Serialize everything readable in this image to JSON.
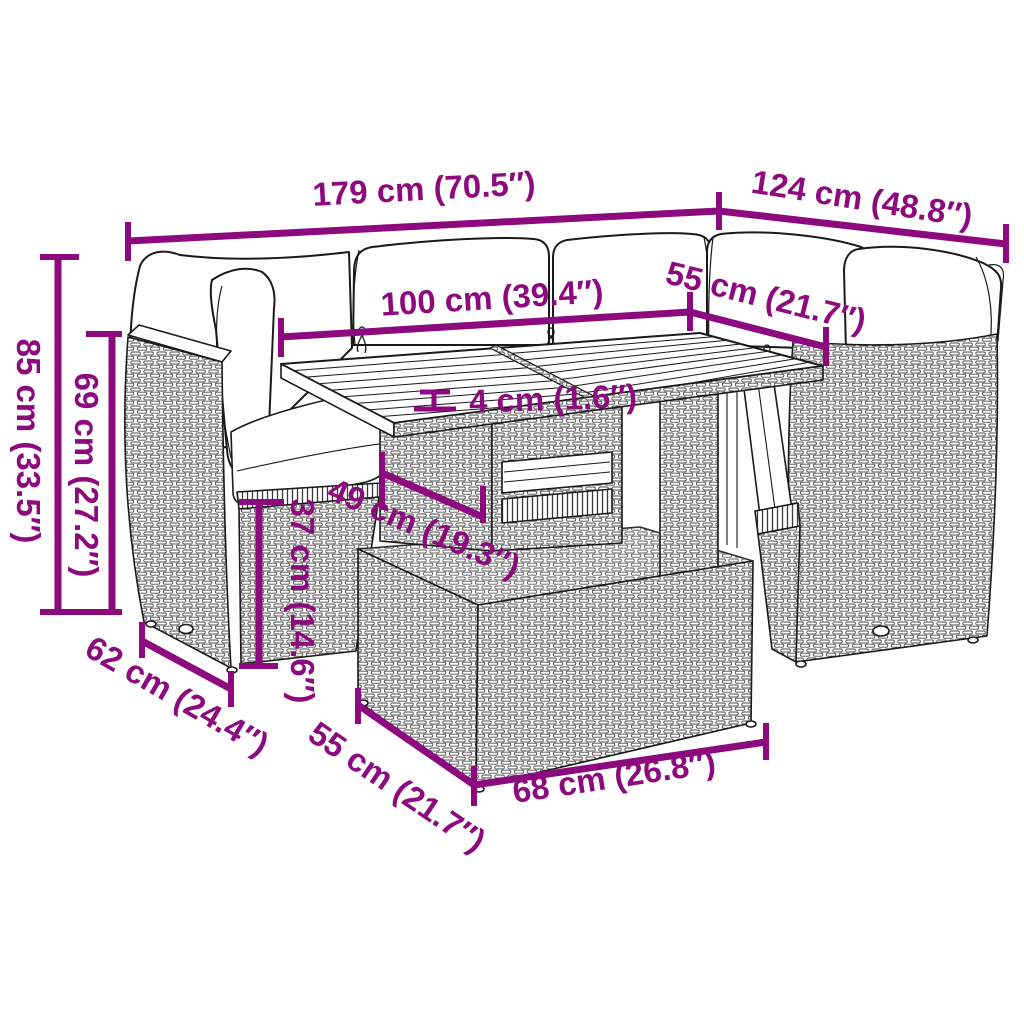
{
  "image": {
    "kind": "product-dimension-diagram",
    "subject": "rattan garden lounge set: corner sofa with cushions, slatted-top table, ottoman",
    "background": "#ffffff"
  },
  "style": {
    "dimension_color": "#8C0A7E",
    "line_art_color": "#1a1a1a"
  },
  "dimensions": [
    {
      "id": "d179",
      "label": "179 cm (70.5″)"
    },
    {
      "id": "d124",
      "label": "124 cm (48.8″)"
    },
    {
      "id": "d100",
      "label": "100 cm (39.4″)"
    },
    {
      "id": "d55-top",
      "label": "55 cm (21.7″)"
    },
    {
      "id": "d4",
      "label": "4 cm (1.6″)"
    },
    {
      "id": "d49",
      "label": "49 cm (19.3″)"
    },
    {
      "id": "d37",
      "label": "37 cm (14.6″)"
    },
    {
      "id": "d85",
      "label": "85 cm (33.5″)"
    },
    {
      "id": "d69",
      "label": "69 cm (27.2″)"
    },
    {
      "id": "d62",
      "label": "62 cm (24.4″)"
    },
    {
      "id": "d55-bot",
      "label": "55 cm (21.7″)"
    },
    {
      "id": "d68",
      "label": "68 cm (26.8″)"
    }
  ]
}
